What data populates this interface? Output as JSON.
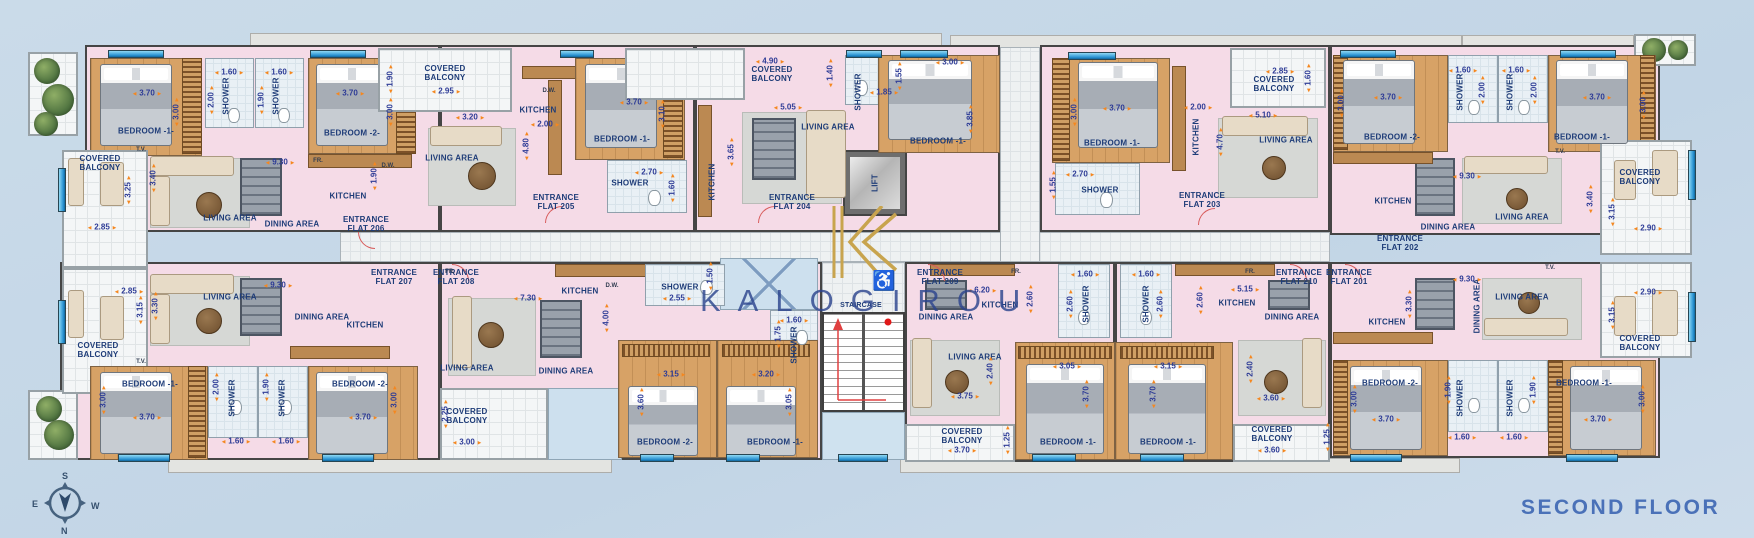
{
  "floor_label": "SECOND FLOOR",
  "watermark": "KALOGIROU",
  "icons": {
    "accessibility": "♿",
    "logo_letter": "K"
  },
  "colors": {
    "floor_text": "#4a71b8",
    "watermark": "#2c448e",
    "dimension_arrows": "#f5871f",
    "dimension_text": "#2d3b96",
    "room_label": "#1e3c78",
    "logo_gold": "#c8a44e",
    "flat_fill": "#f5dbe7",
    "bedroom_floor": "#d7a266",
    "background": "#c5d7e7"
  },
  "compass": {
    "n": "N",
    "s": "S",
    "e": "E",
    "w": "W"
  },
  "core": {
    "lift": "LIFT",
    "staircase": "STAIRCASE"
  },
  "common": {
    "bedroom1": "BEDROOM -1-",
    "bedroom2": "BEDROOM -2-",
    "shower": "SHOWER",
    "living": "LIVING AREA",
    "dining": "DINING AREA",
    "kitchen": "KITCHEN",
    "balcony": "COVERED BALCONY",
    "tv": "T.V.",
    "fridge": "FR.",
    "dishwasher": "D.W."
  },
  "flats": {
    "f206": {
      "entrance": "ENTRANCE FLAT 206",
      "dims": {
        "bed1_w": "3.70",
        "bed1_h": "3.00",
        "sh1_w": "1.60",
        "sh1_h": "2.00",
        "sh2_w": "1.60",
        "sh2_h": "1.90",
        "bed2_w": "3.70",
        "bed2_h": "3.00",
        "liv_w": "9.30",
        "liv_h": "3.40",
        "balc_w": "2.85",
        "balc_h": "3.25",
        "kit_h": "1.90"
      }
    },
    "f205": {
      "entrance": "ENTRANCE FLAT 205",
      "dims": {
        "balc_w": "2.95",
        "balc_h": "1.90",
        "liv_w": "3.20",
        "liv_h": "4.80",
        "kit_w": "2.00",
        "bed1_w": "3.70",
        "bed1_h": "3.10",
        "sh_w": "2.70",
        "sh_h": "1.60"
      }
    },
    "f204": {
      "entrance": "ENTRANCE FLAT 204",
      "dims": {
        "balc_w": "4.90",
        "balc_h": "1.40",
        "liv_w": "5.05",
        "liv_h": "3.65",
        "sh_w": "1.85",
        "sh_h": "1.55",
        "bed1_w": "3.00",
        "bed1_h": "3.85"
      }
    },
    "f203": {
      "entrance": "ENTRANCE FLAT 203",
      "dims": {
        "bed1_w": "3.70",
        "bed1_h": "3.00",
        "sh_w": "2.70",
        "sh_h": "1.55",
        "kit_w": "2.00",
        "balc_w": "2.85",
        "balc_h": "1.60",
        "liv_w": "5.10",
        "liv_h": "4.70"
      }
    },
    "f202": {
      "entrance": "ENTRANCE FLAT 202",
      "dims": {
        "bed2_w": "3.70",
        "bed2_h": "3.00",
        "sh1_w": "1.60",
        "sh1_h": "2.00",
        "sh2_w": "1.60",
        "sh2_h": "2.00",
        "bed1_w": "3.70",
        "bed1_h": "3.00",
        "liv_w": "9.30",
        "liv_h": "3.40",
        "balc_w": "2.90",
        "balc_h": "3.15"
      }
    },
    "f201": {
      "entrance": "ENTRANCE FLAT 201",
      "dims": {
        "liv_w": "9.30",
        "liv_h": "3.30",
        "bed2_w": "3.70",
        "bed2_h": "3.00",
        "sh1_w": "1.60",
        "sh1_h": "1.90",
        "sh2_w": "1.60",
        "sh2_h": "1.90",
        "bed1_w": "3.70",
        "bed1_h": "3.00",
        "balc_w": "2.90",
        "balc_h": "3.15"
      }
    },
    "f207": {
      "entrance": "ENTRANCE FLAT 207",
      "dims": {
        "balc_w": "2.85",
        "balc_h": "3.15",
        "liv_w": "9.30",
        "liv_h": "3.30",
        "bed1_w": "3.70",
        "bed1_h": "3.00",
        "sh1_w": "1.60",
        "sh1_h": "2.00",
        "sh2_w": "1.60",
        "sh2_h": "1.90",
        "bed2_w": "3.70",
        "bed2_h": "3.00"
      }
    },
    "f208": {
      "entrance": "ENTRANCE FLAT 208",
      "dims": {
        "liv_w": "7.30",
        "liv_h": "4.00",
        "sh1_w": "2.55",
        "sh1_h": "1.50",
        "sh2_w": "1.60",
        "sh2_h": "1.75",
        "balc_w": "3.00",
        "balc_h": "2.25",
        "bed2_w": "3.15",
        "bed2_h": "3.60",
        "bed1_w": "3.20",
        "bed1_h": "3.05"
      }
    },
    "f209": {
      "entrance": "ENTRANCE FLAT 209",
      "dims": {
        "kit_w": "6.20",
        "kit_h": "2.60",
        "sh_w": "1.60",
        "sh_h": "2.60",
        "liv_w": "3.75",
        "liv_h": "2.40",
        "bed1_w": "3.05",
        "bed1_h": "3.70",
        "balc_w": "3.70",
        "balc_h": "1.25"
      }
    },
    "f210": {
      "entrance": "ENTRANCE FLAT 210",
      "dims": {
        "kit_w": "5.15",
        "kit_h": "2.60",
        "sh_w": "1.60",
        "sh_h": "2.60",
        "liv_w": "3.60",
        "liv_h": "2.40",
        "bed1_w": "3.15",
        "bed1_h": "3.70",
        "balc_w": "3.60",
        "balc_h": "1.25"
      }
    }
  }
}
